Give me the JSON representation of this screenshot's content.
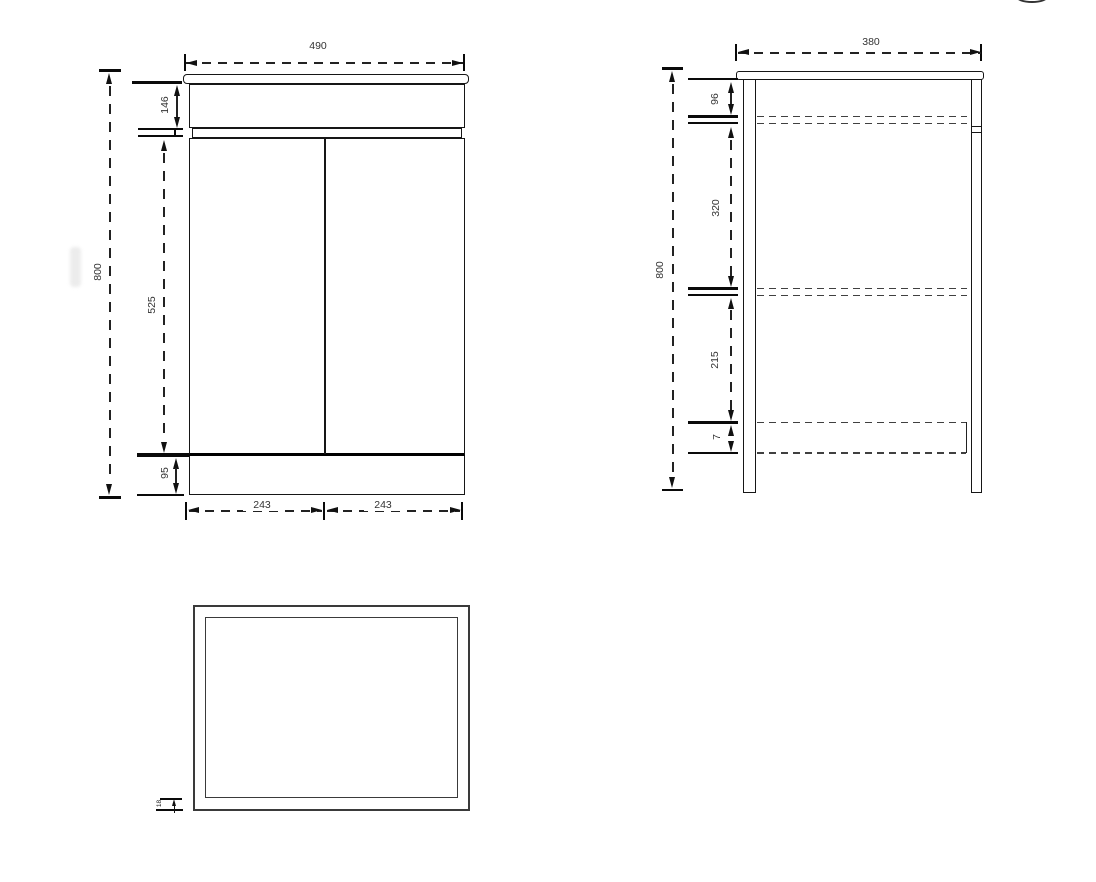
{
  "front_view": {
    "overall_width": "490",
    "overall_height": "800",
    "top_panel_height": "146",
    "door_height": "525",
    "plinth_height": "95",
    "left_door_width": "243",
    "right_door_width": "243"
  },
  "side_view": {
    "overall_depth": "380",
    "overall_height": "800",
    "top_section": "96",
    "upper_shelf_section": "320",
    "lower_shelf_section": "215",
    "bottom_shelf_section": "7"
  },
  "top_view": {
    "frame_thickness": "18"
  },
  "colors": {
    "line": "#161616",
    "gray_line": "#3a3a3a",
    "dim_text": "#333333",
    "background": "#ffffff"
  }
}
